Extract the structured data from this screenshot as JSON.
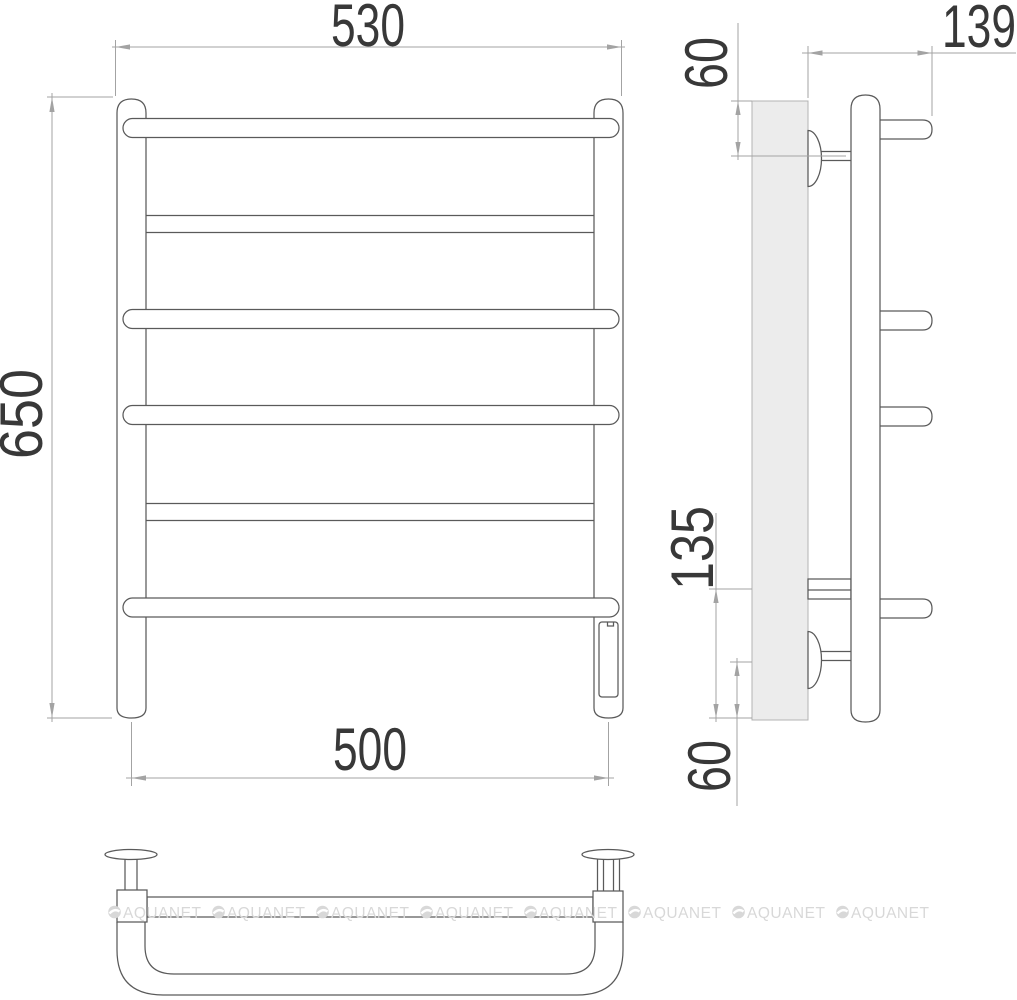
{
  "drawing": {
    "type": "technical-drawing",
    "subject": "ladder towel rail with six crossbars, wall mounting brackets and heating element",
    "front_view": {
      "dim_width_top": "530",
      "dim_height": "650",
      "dim_width_bottom": "500"
    },
    "side_view": {
      "dim_depth": "139",
      "dim_top_bracket_offset": "60",
      "dim_bottom_bar_offset": "135",
      "dim_bottom_bracket_offset": "60"
    },
    "watermark": {
      "text": "AQUANET",
      "color": "#d8d8d8"
    },
    "colors": {
      "line": "#5a5a5a",
      "dimension": "#a3a3a3",
      "text": "#383838",
      "wall_fill": "#ececec",
      "background": "#ffffff"
    }
  }
}
